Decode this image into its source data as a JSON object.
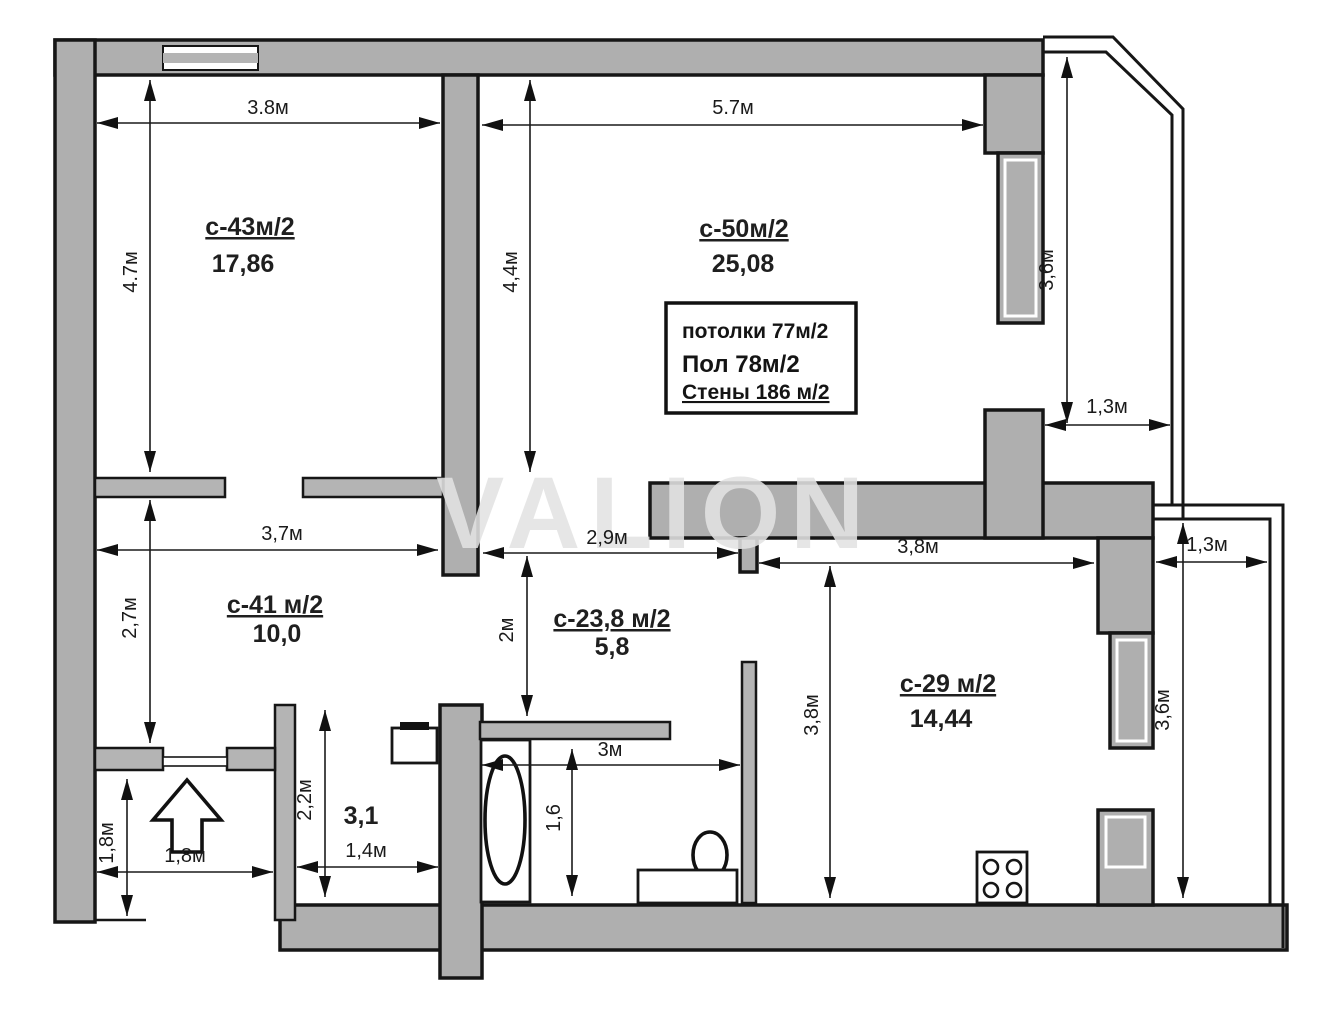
{
  "plan": {
    "watermark": "VALION",
    "rooms": {
      "room1": {
        "name": "с-43м/2",
        "area": "17,86"
      },
      "room2": {
        "name": "с-50м/2",
        "area": "25,08"
      },
      "room3": {
        "name": "с-41 м/2",
        "area": "10,0"
      },
      "hall": {
        "name": "с-23,8 м/2",
        "area": "5,8"
      },
      "kitchen": {
        "name": "с-29 м/2",
        "area": "14,44"
      },
      "wc": {
        "area": "3,1"
      }
    },
    "info_box": {
      "ceilings": "потолки 77м/2",
      "floor": "Пол 78м/2",
      "walls": "Стены 186 м/2"
    },
    "dims": {
      "room1_w": "3.8м",
      "room1_h": "4.7м",
      "room2_w": "5.7м",
      "room2_h": "4,4м",
      "balc_top_h": "3,6м",
      "balc_top_w": "1,3м",
      "room3_w": "3,7м",
      "room3_h": "2,7м",
      "hall_w": "2,9м",
      "hall_h": "2м",
      "kitchen_w": "3,8м",
      "kitchen_h": "3,8м",
      "balc_bot_w": "1,3м",
      "balc_bot_h": "3,6м",
      "wc_h": "2,2м",
      "wc_w": "1,4м",
      "entry_h": "1,8м",
      "entry_w": "1,8м",
      "bath_w": "3м",
      "bath_h": "1,6"
    },
    "colors": {
      "wall_fill": "#afafaf",
      "outline": "#161616",
      "watermark": "#e2e2e2",
      "background": "#ffffff"
    }
  }
}
